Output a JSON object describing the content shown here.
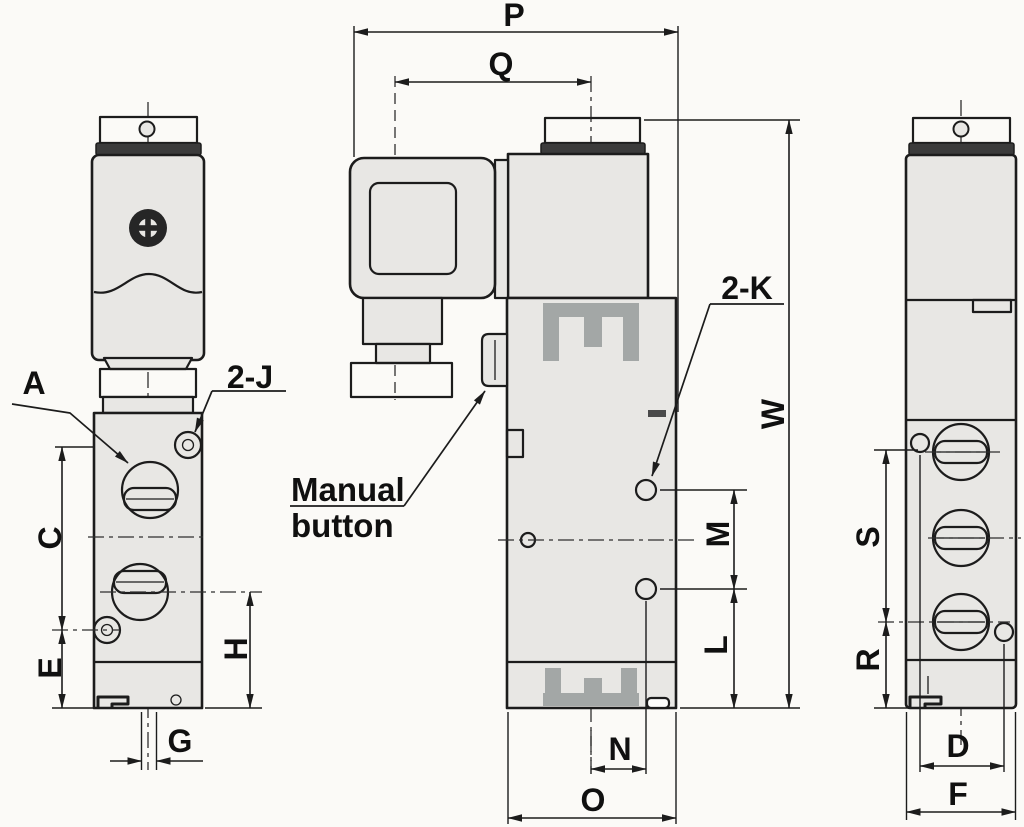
{
  "labels": {
    "p": "P",
    "q": "Q",
    "a": "A",
    "two_j": "2-J",
    "two_k": "2-K",
    "w": "W",
    "c": "C",
    "e": "E",
    "g": "G",
    "h": "H",
    "m": "M",
    "l": "L",
    "n": "N",
    "o": "O",
    "s": "S",
    "r": "R",
    "d": "D",
    "f": "F"
  },
  "annotations": {
    "manual_line1": "Manual",
    "manual_line2": "button"
  },
  "colors": {
    "line": "#1c1c1c",
    "body_fill": "#e8e7e4",
    "dark_band": "#3b3b3b",
    "bracket_gray": "#a3a7a6",
    "background": "#fbfaf7"
  }
}
